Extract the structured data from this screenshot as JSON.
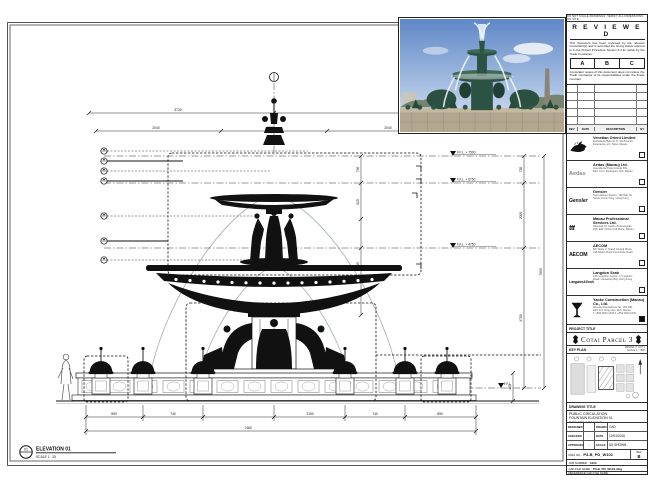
{
  "sheet_note": "DO NOT SCALE DRAWINGS. VERIFY ALL DIMENSIONS ON SITE.",
  "stamp": {
    "title": "R E V I E W E D",
    "para1": "This document has been reviewed by the relevant Consultant(s) and is accorded the timing status referred to in the Project Procedure Section 5.4 for action by the Trade Contractor.",
    "box_a": "A",
    "box_b": "B",
    "box_c": "C",
    "para2": "Consultant review of this document does not relieve the Trade Contractor of its responsibilities under the Trade Contract.",
    "date_label": "Date :"
  },
  "revision_table": {
    "headers": [
      "REV",
      "DATE",
      "DESCRIPTION",
      "BY"
    ]
  },
  "consultants": [
    {
      "logo_text": "",
      "name": "Venetian Orient Limited",
      "addr1": "Estrada da Baía de N. Senhora da",
      "addr2": "Esperança, s/n, Taipa, Macau"
    },
    {
      "logo_text": "Aedas",
      "name": "Aedas (Macau) Ltd.",
      "addr1": "Avenida da Praia Grande 599,",
      "addr2": "Edif. Com. Rodrigues 12/F, Macau"
    },
    {
      "logo_text": "Gensler",
      "name": "Gensler",
      "addr1": "Two Harbour Square, 180 Wai Yip",
      "addr2": "Street, Kwun Tong, Hong Kong"
    },
    {
      "logo_text": "ttt",
      "name": "Macau Professional Services Ltd.",
      "addr1": "Alameda Dr. Carlos d'Assumpção",
      "addr2": "263, Edif. China Civil Plaza, Macau"
    },
    {
      "logo_text": "AECOM",
      "name": "AECOM",
      "addr1": "8/F Tower 2, Grand Central Plaza,",
      "addr2": "138 Shatin Rural Committee Road"
    },
    {
      "logo_text": "Langdon&Seah",
      "name": "Langdon Seah",
      "addr1": "21/F Leighton Centre, 77 Leighton",
      "addr2": "Road, Causeway Bay, Hong Kong"
    }
  ],
  "contractor": {
    "name": "Yaoke Construction (Macau) Co., Ltd.",
    "addr1": "Rua dos Pescadores No. 166-190,",
    "addr2": "Edif. Ind. Veng Hou, 11/F, Macau",
    "addr3": "T +853 2843 1026   F +853 2843 1030"
  },
  "project": {
    "header": "PROJECT TITLE",
    "title": "Cotai Parcel 3"
  },
  "key_plan": {
    "header": "KEY PLAN",
    "note": "PARCEL 3, LOT 2",
    "scale": "SCALE 1 : 7500"
  },
  "drawing_title": {
    "header": "DRAWING TITLE",
    "line1": "PUBLIC CIRCULATION",
    "line2": "FOUNTAIN ELEVATION 01",
    "line3": "FOR FBF DRAWING"
  },
  "approval": {
    "designed_label": "DESIGNED",
    "designed_value": "-",
    "drawn_label": "DRAWN",
    "drawn_value": "CAD",
    "checked_label": "CHECKED",
    "checked_value": "-",
    "date_label": "DATE",
    "date_value": "12/04/2016",
    "approved_label": "APPROVED",
    "approved_value": "-",
    "scale_label": "SCALE",
    "scale_value": "AS SHOWN"
  },
  "numbers": {
    "dwg_label": "DWG NO :",
    "dwg_value": "P3-B_PD_W101",
    "rev_label": "REV",
    "rev_value": "B",
    "job_label": "JOB NUMBER :",
    "job_value": "3123",
    "cad_label": "CAD FILE NAME :",
    "cad_value": "P3-B_PD_W101.dwg",
    "ref_label": "REFERENCE CAD FILE NAME :"
  },
  "drawing": {
    "levels": {
      "l1": "F.F.L. + 7500",
      "l2": "F.F.L. + 6750",
      "l3": "F.F.L. + 4750",
      "l4": "F.F.L."
    },
    "elevation": {
      "bubble_no": "01",
      "bubble_ref": "-",
      "title": "ELEVATION 01",
      "scale": "SCALE  1 : 25"
    },
    "dims": {
      "top1_a": "3730",
      "top1_b": "3730",
      "top2_a": "2040",
      "top2_b": "1730",
      "top2_c": "2040",
      "right_a": "750",
      "right_b": "2000",
      "right_c": "4750",
      "right_total": "7500",
      "mid_a": "750",
      "mid_b": "520",
      "mid_c": "785",
      "bot_a": "890",
      "bot_b": "740",
      "bot_c": "2190",
      "bot_d": "740",
      "bot_e": "890",
      "overall": "7460",
      "wall": "450"
    }
  },
  "colors": {
    "line": "#1a1a1a",
    "sky": "#5f87c7",
    "fountain_green": "#2c5244",
    "stone": "#b3a78f"
  }
}
